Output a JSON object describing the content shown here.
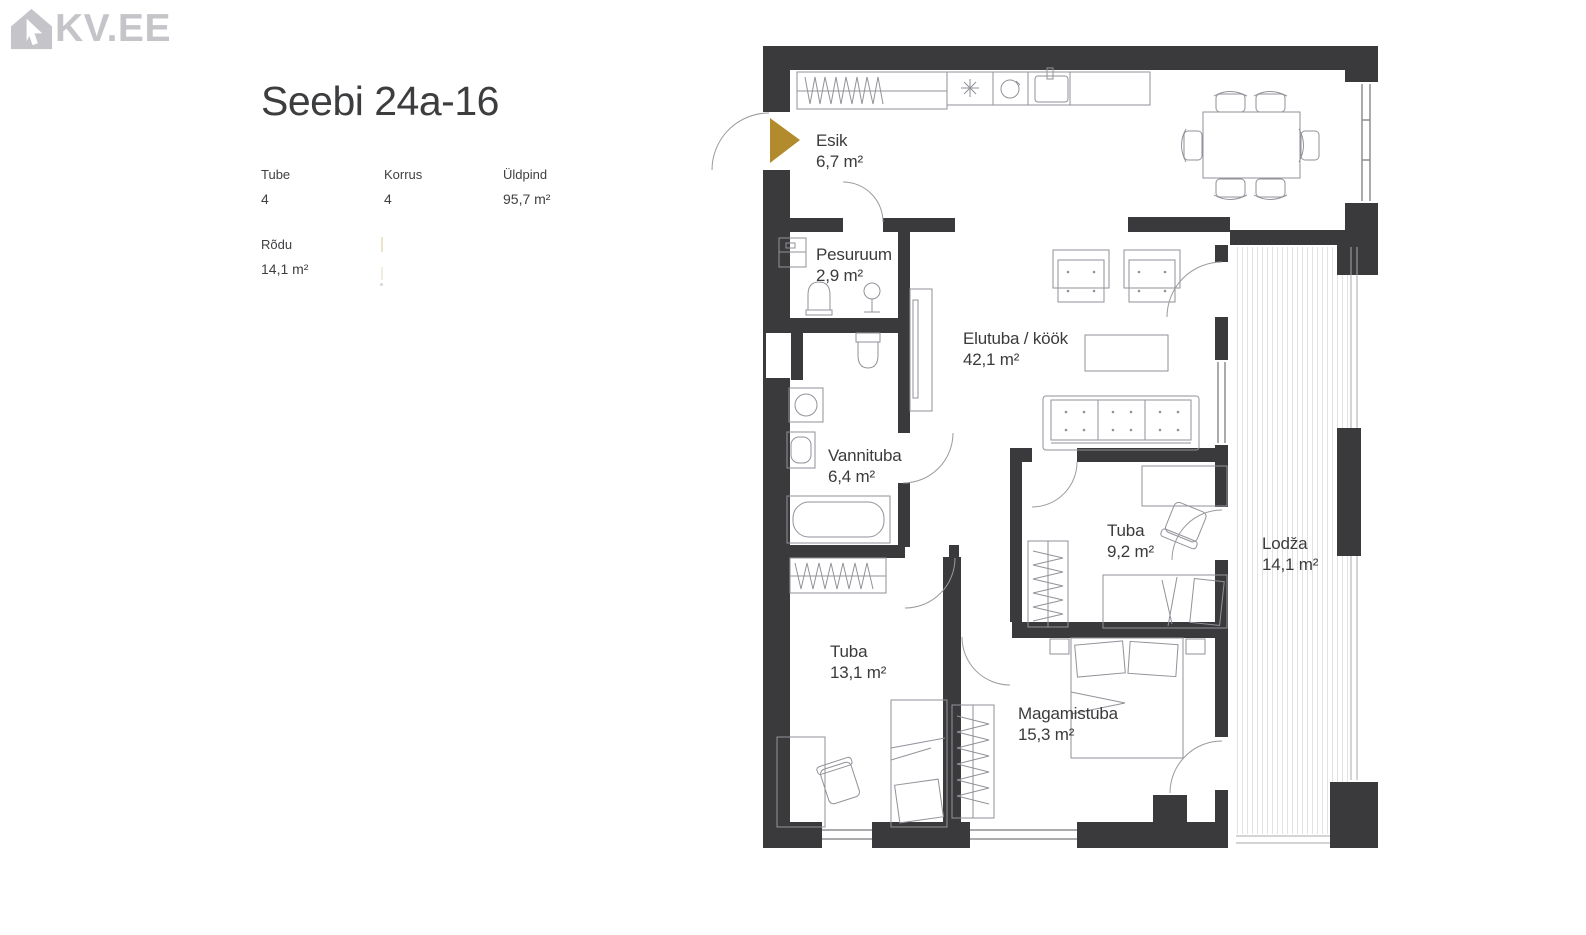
{
  "logo": {
    "text": "KV.EE",
    "color": "#c5c5c9"
  },
  "listing": {
    "title": "Seebi 24a-16",
    "fields": [
      {
        "label": "Tube",
        "value": "4"
      },
      {
        "label": "Korrus",
        "value": "4"
      },
      {
        "label": "Üldpind",
        "value": "95,7 m²"
      },
      {
        "label": "Rõdu",
        "value": "14,1 m²"
      }
    ]
  },
  "floorplan": {
    "rooms": [
      {
        "name": "Esik",
        "area": "6,7 m²"
      },
      {
        "name": "Pesuruum",
        "area": "2,9 m²"
      },
      {
        "name": "Elutuba / köök",
        "area": "42,1 m²"
      },
      {
        "name": "Vannituba",
        "area": "6,4 m²"
      },
      {
        "name": "Tuba",
        "area": "9,2 m²"
      },
      {
        "name": "Lodža",
        "area": "14,1 m²"
      },
      {
        "name": "Tuba",
        "area": "13,1 m²"
      },
      {
        "name": "Magamistuba",
        "area": "15,3 m²"
      }
    ],
    "symbols": [
      "entrance-arrow",
      "wardrobe",
      "fridge",
      "hob",
      "kitchen-sink",
      "dining-table",
      "chair",
      "armchair",
      "coffee-table",
      "sofa",
      "tv-cabinet",
      "washbasin",
      "toilet",
      "washing-machine",
      "bathtub",
      "bed",
      "double-bed",
      "desk",
      "nightstand",
      "window",
      "door-arc",
      "loggia-hatch"
    ],
    "colors": {
      "wall": "#3a3a3c",
      "entrance_marker": "#b28c2c",
      "furniture": "#92929a"
    }
  }
}
